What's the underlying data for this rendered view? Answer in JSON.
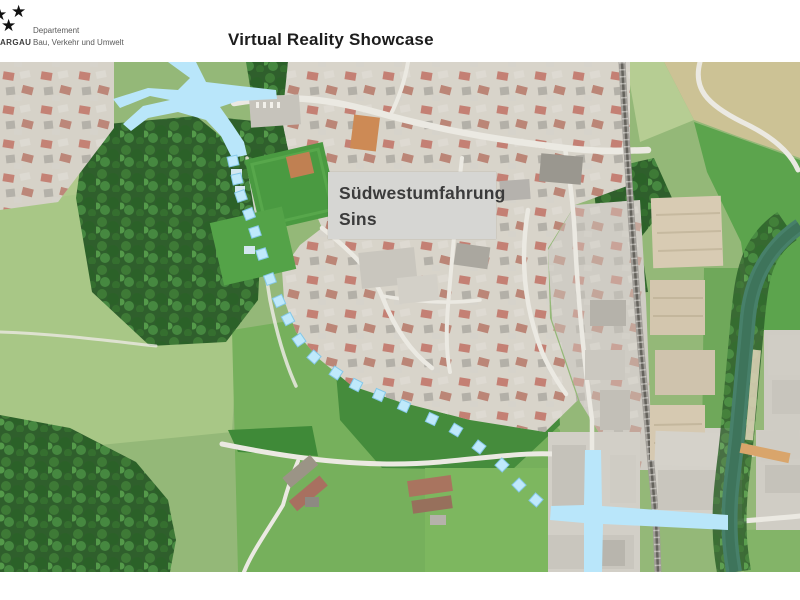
{
  "header": {
    "title": "Virtual Reality Showcase",
    "logo": {
      "brand_text": "ARGAU",
      "department_line1": "Departement",
      "department_line2": "Bau, Verkehr und Umwelt"
    }
  },
  "map": {
    "project_label": {
      "line1": "Südwestumfahrung",
      "line2": "Sins",
      "background": "#d6d6d3",
      "text_color": "#3b3b3b"
    },
    "route": {
      "highlight_color": "#b9e6fa",
      "marker_fill": "#bfe9fb",
      "marker_border": "#85c8e9",
      "marker_size": 10,
      "markers": [
        [
          233,
          161
        ],
        [
          237,
          179
        ],
        [
          241,
          196
        ],
        [
          249,
          214
        ],
        [
          255,
          232
        ],
        [
          262,
          254
        ],
        [
          270,
          279
        ],
        [
          279,
          301
        ],
        [
          288,
          319
        ],
        [
          299,
          340
        ],
        [
          314,
          357
        ],
        [
          336,
          373
        ],
        [
          356,
          385
        ],
        [
          379,
          395
        ],
        [
          404,
          406
        ],
        [
          432,
          419
        ],
        [
          456,
          430
        ],
        [
          479,
          447
        ],
        [
          502,
          465
        ],
        [
          519,
          485
        ],
        [
          536,
          500
        ]
      ]
    }
  }
}
